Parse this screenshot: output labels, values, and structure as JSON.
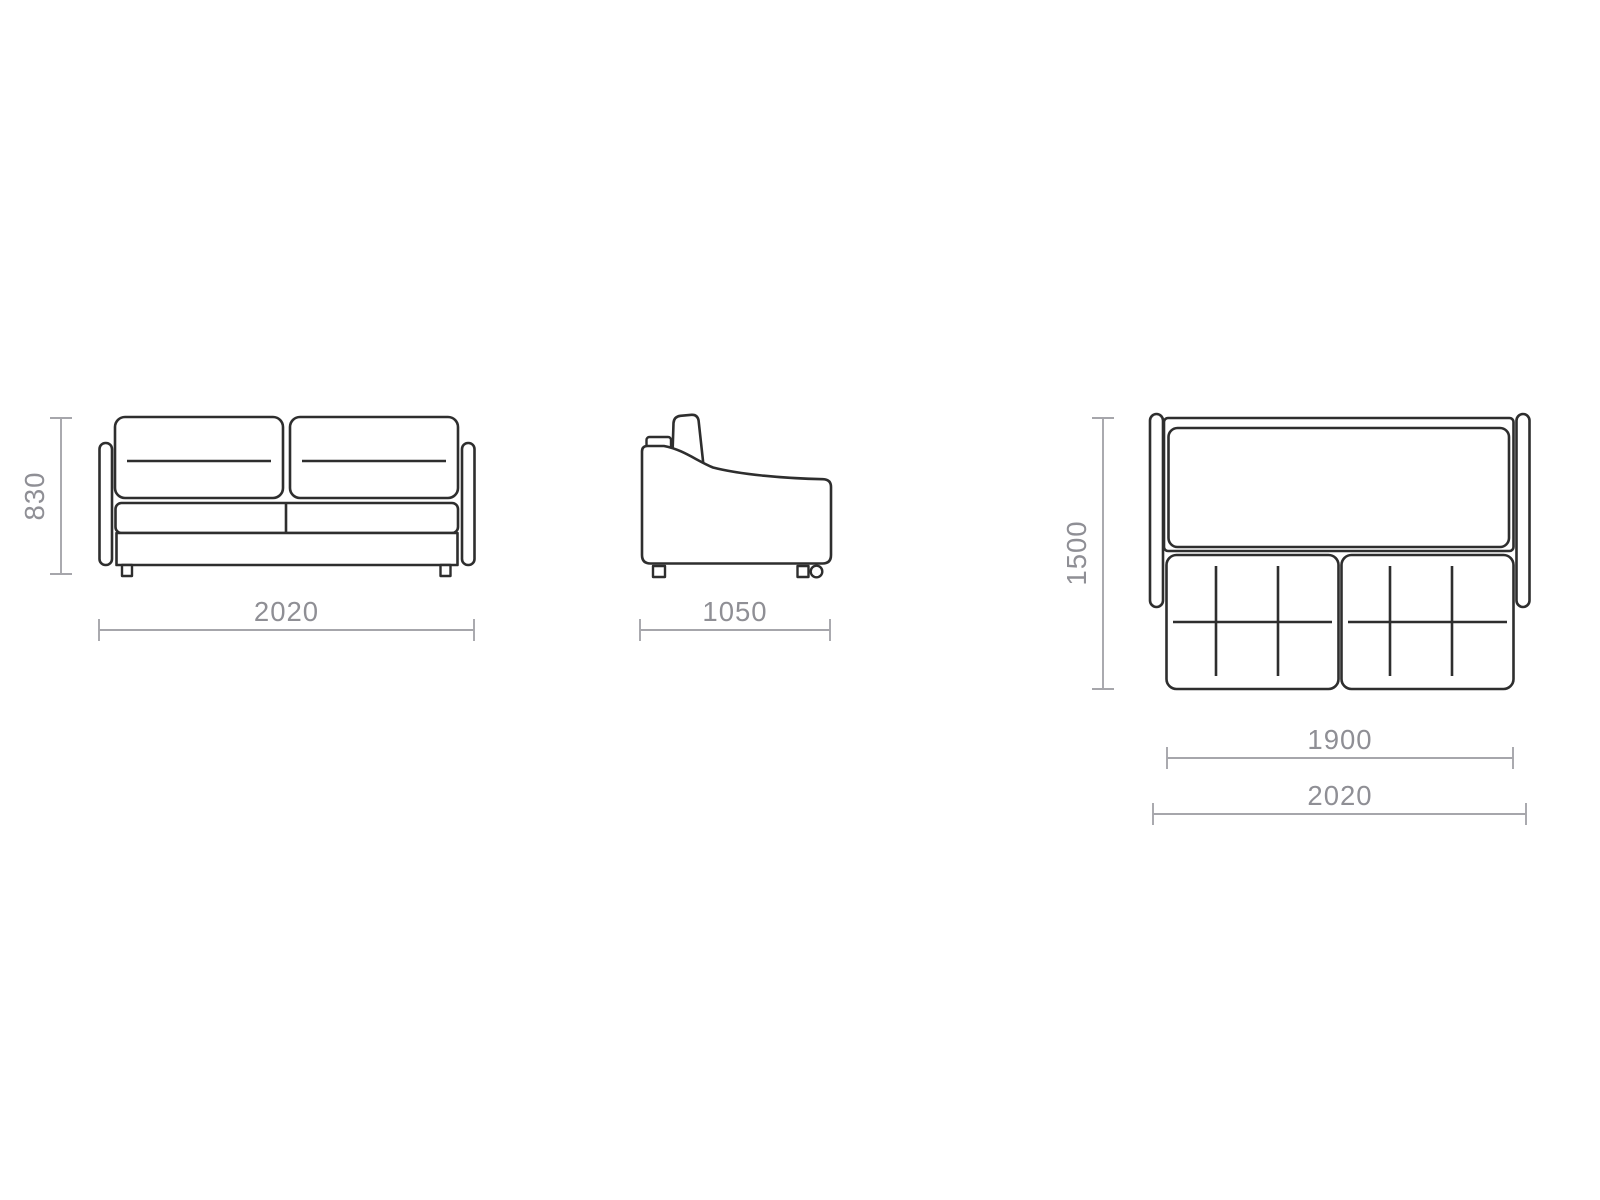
{
  "colors": {
    "outline": "#2e2e2e",
    "dimline": "#a6a6ab",
    "dimtext": "#8f8f95",
    "background": "#ffffff"
  },
  "views": {
    "front": {
      "height": "830",
      "width": "2020"
    },
    "side": {
      "depth": "1050"
    },
    "top": {
      "depth": "1500",
      "mattress_width": "1900",
      "overall_width": "2020"
    }
  }
}
